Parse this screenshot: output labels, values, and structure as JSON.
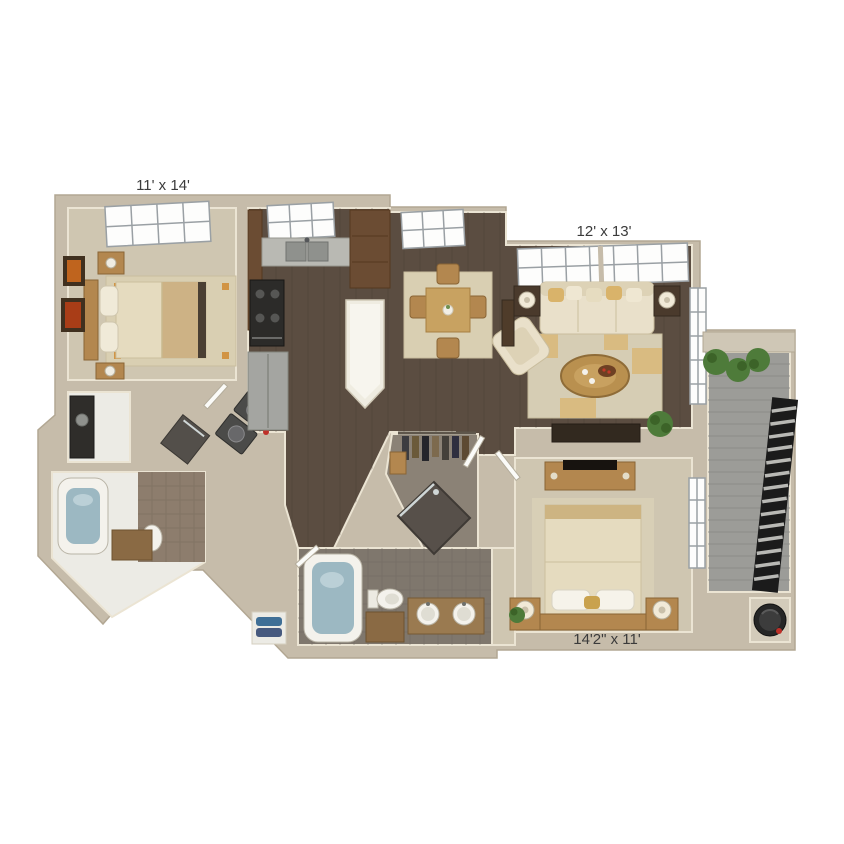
{
  "image": {
    "kind": "3d-apartment-floor-plan-render",
    "background": "#ffffff",
    "units": "feet"
  },
  "labels": {
    "bedroom_top_left": "11' x 14'",
    "living_room": "12' x 13'",
    "bedroom_bottom_right": "14'2\" x 11'"
  },
  "rooms_depicted": [
    "bedroom (top left)",
    "bathroom with tub (left)",
    "laundry closet",
    "kitchen",
    "dining area",
    "living room",
    "walk-in closet",
    "master bathroom",
    "bedroom (bottom right)",
    "balcony",
    "storage closet"
  ],
  "palette": {
    "wall_beige": "#c6bcaa",
    "carpet": "#cfc6b1",
    "wood_floor": "#5b4d41",
    "tile_gray": "#7f776d",
    "tile_brown": "#8d7d6d",
    "deck_gray": "#9c9c98",
    "cream_fabric": "#e9e0ca",
    "tan_accent": "#d9b778",
    "furniture_wood": "#b3874f",
    "cabinet_brown": "#6b4c33",
    "tub_water": "#9cb8c2",
    "plant_green": "#4e7b3a",
    "railing_black": "#1b1b1b",
    "label_text": "#3b3b3b"
  }
}
